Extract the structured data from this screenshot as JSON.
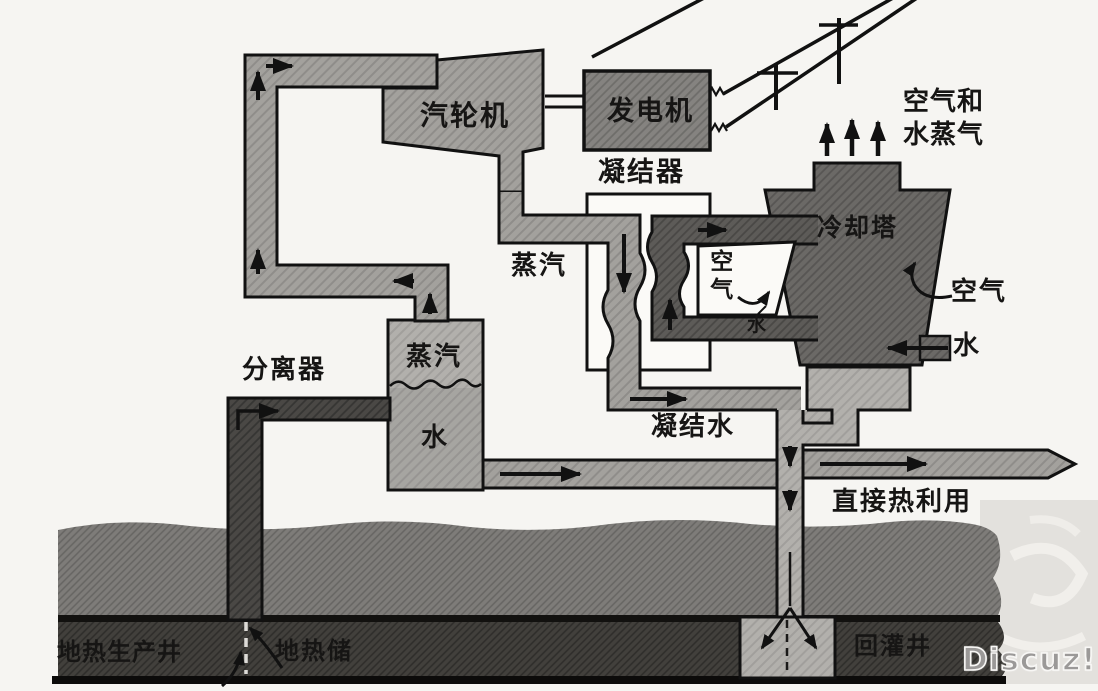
{
  "diagram": {
    "labels": {
      "turbine": "汽轮机",
      "generator": "发电机",
      "condenser": "凝结器",
      "steam_exhaust": "蒸汽",
      "cooling_tower": "冷却塔",
      "air_and_vapor": "空气和水蒸气",
      "air_inlet": "空气",
      "spray_water": "水",
      "air_right": "空气",
      "makeup_water": "水",
      "separator": "分离器",
      "separator_steam": "蒸汽",
      "separator_water": "水",
      "condensate": "凝结水",
      "direct_heat_use": "直接热利用",
      "production_well": "地热生产井",
      "reservoir": "地热储",
      "injection_well": "回灌井"
    },
    "watermark": "Discuz!",
    "colors": {
      "background": "#f6f5f2",
      "steam_pipe_gray": "#a3a19d",
      "generator_gray": "#858380",
      "tower_gray": "#6b6966",
      "cooling_loop_gray": "#5d5b58",
      "production_well_gray": "#4a4845",
      "light_pipe_gray": "#b2b0ac",
      "upper_ground": "#7e7c79",
      "reservoir": "#42403c",
      "condenser_white": "#fbfaf7",
      "outline_black": "#111111",
      "watermark_gray": "#9b9998"
    },
    "icons": {
      "flow-arrow": "black triangular flow arrowhead",
      "vapor-up-arrows": "three upward arrows above cooling tower",
      "transmission-line": "diagonal power lines with poles leaving generator",
      "dashed-open-hole": "dashed line marking open well bore in reservoir"
    }
  }
}
